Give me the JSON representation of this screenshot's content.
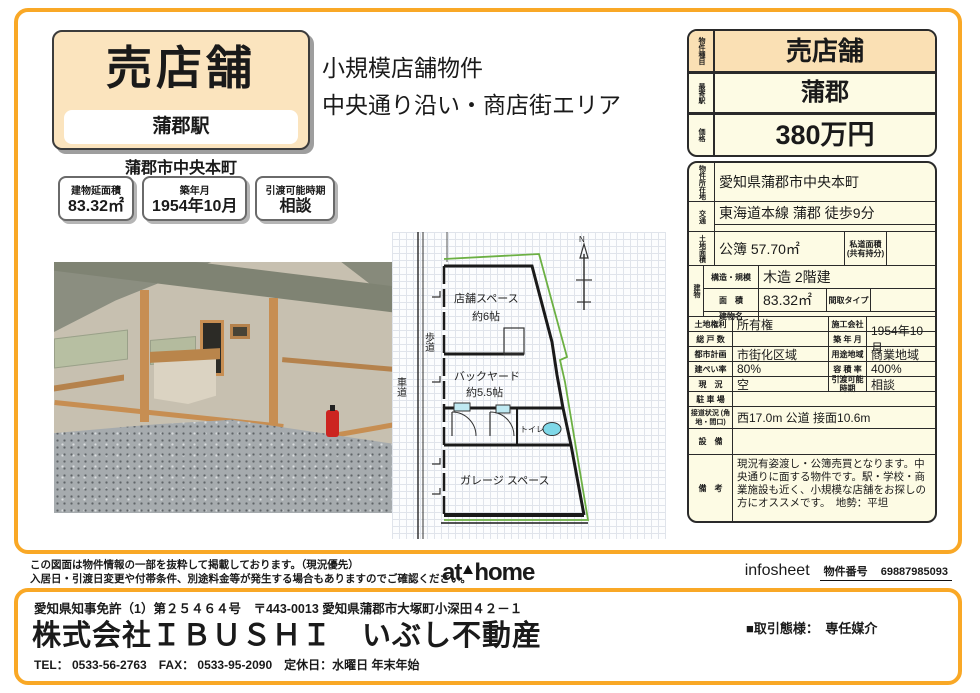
{
  "header": {
    "title": "売店舗",
    "station": "蒲郡駅",
    "district": "蒲郡市中央本町",
    "catch_line1": "小規模店舗物件",
    "catch_line2": "中央通り沿い・商店街エリア",
    "facts": [
      {
        "label": "建物延面積",
        "value": "83.32㎡"
      },
      {
        "label": "築年月",
        "value": "1954年10月"
      },
      {
        "label": "引渡可能時期",
        "value": "相談"
      }
    ]
  },
  "summary": {
    "type_label": "物件種目",
    "type": "売店舗",
    "station_label": "最寄駅",
    "station": "蒲郡",
    "price_label": "価格",
    "price": "380万円"
  },
  "detail_table": {
    "location_label": "物件所在地",
    "location": "愛知県蒲郡市中央本町",
    "access_label": "交通",
    "access_line1": "東海道本線 蒲郡 徒歩9分",
    "access_line2": "",
    "land_label": "土地面積",
    "land": "公簿 57.70㎡",
    "private_road_label": "私道面積 (共有持分)",
    "private_road": "",
    "building_label": "建物",
    "structure_label": "構造・規模",
    "structure": "木造 2階建",
    "area_label": "面　積",
    "area": "83.32㎡",
    "layout_label": "間取タイプ",
    "layout": "",
    "bname_label": "建物名",
    "bname": "",
    "pairs": [
      {
        "l1": "土地権利",
        "v1": "所有権",
        "l2": "施工会社",
        "v2": ""
      },
      {
        "l1": "総 戸 数",
        "v1": "",
        "l2": "築 年 月",
        "v2": "1954年10月"
      },
      {
        "l1": "都市計画",
        "v1": "市街化区域",
        "l2": "用途地域",
        "v2": "商業地域"
      },
      {
        "l1": "建ぺい率",
        "v1": "80%",
        "l2": "容 積 率",
        "v2": "400%"
      },
      {
        "l1": "現　況",
        "v1": "空",
        "l2": "引渡可能 時期",
        "v2": "相談"
      }
    ],
    "parking_label": "駐 車 場",
    "parking": "",
    "road_label": "接道状況 (角地・間口)",
    "road": "西17.0m 公道 接面10.6m",
    "equipment_label": "設　備",
    "equipment": "",
    "remarks_label": "備　考",
    "remarks": "現況有姿渡し・公簿売買となります。中央通りに面する物件です。駅・学校・商業施設も近く、小規模な店舗をお探しの方にオススメです。　地勢：平坦"
  },
  "floorplan": {
    "north": "N",
    "sidewalk": "歩道",
    "road": "車道",
    "shop_line1": "店舗スペース",
    "shop_line2": "約6帖",
    "backyard_line1": "バックヤード",
    "backyard_line2": "約5.5帖",
    "toilet": "トイレ",
    "garage": "ガレージ スペース"
  },
  "footer": {
    "disclaimer_line1": "この図面は物件情報の一部を抜粋して掲載しております。（現況優先）",
    "disclaimer_line2": "入居日・引渡日変更や付帯条件、別途料金等が発生する場合もありますのでご確認ください。",
    "athome_at": "at",
    "athome_home": "home",
    "infosheet": "infosheet",
    "property_no_label": "物件番号",
    "property_no": "69887985093",
    "license": "愛知県知事免許（1）第２５４６４号　〒443-0013 愛知県蒲郡市大塚町小深田４２－１",
    "company": "株式会社ＩＢＵＳＨＩ　いぶし不動産",
    "contact": "TEL： 0533-56-2763　FAX： 0533-95-2090　定休日：水曜日 年末年始",
    "transaction": "■取引態様：　専任媒介"
  },
  "colors": {
    "accent": "#F9A826",
    "peach": "#FAE0B4",
    "cream": "#FDFBE4"
  }
}
